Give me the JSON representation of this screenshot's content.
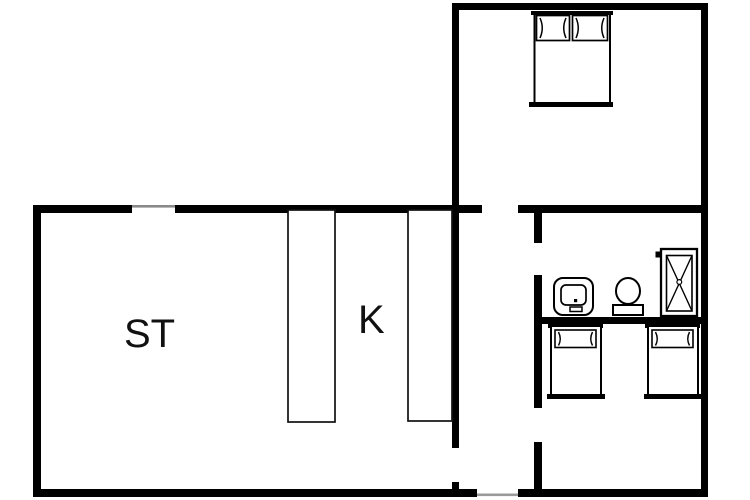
{
  "plan": {
    "type": "apartment-floor-plan",
    "background_color": "#ffffff",
    "wall_color": "#000000",
    "opening_line_color": "#8a8a8a",
    "rooms": {
      "living_room": {
        "label": "ST"
      },
      "kitchen": {
        "label": "K"
      }
    },
    "icons": {
      "double_bed": "double bed with two pillows (top-right bedroom)",
      "single_bed_left": "single bed with pillow (bottom-right room, left)",
      "single_bed_right": "single bed with pillow (bottom-right room, right)",
      "sink": "bathroom washbasin",
      "toilet": "toilet seen from above",
      "shower": "shower tray with X and drain dot",
      "counter_left": "kitchen counter / cabinet strip",
      "counter_right": "kitchen counter / cabinet strip"
    },
    "openings": {
      "living_room_window": "opening in top wall of ST room",
      "entrance_door": "opening in bottom wall of hallway",
      "bedroom_door": "opening in wall between hallway and bedroom",
      "bathroom_door": "opening in wall between hallway and bathroom",
      "twin_room_door": "opening in wall between hallway and twin-bed room"
    }
  }
}
